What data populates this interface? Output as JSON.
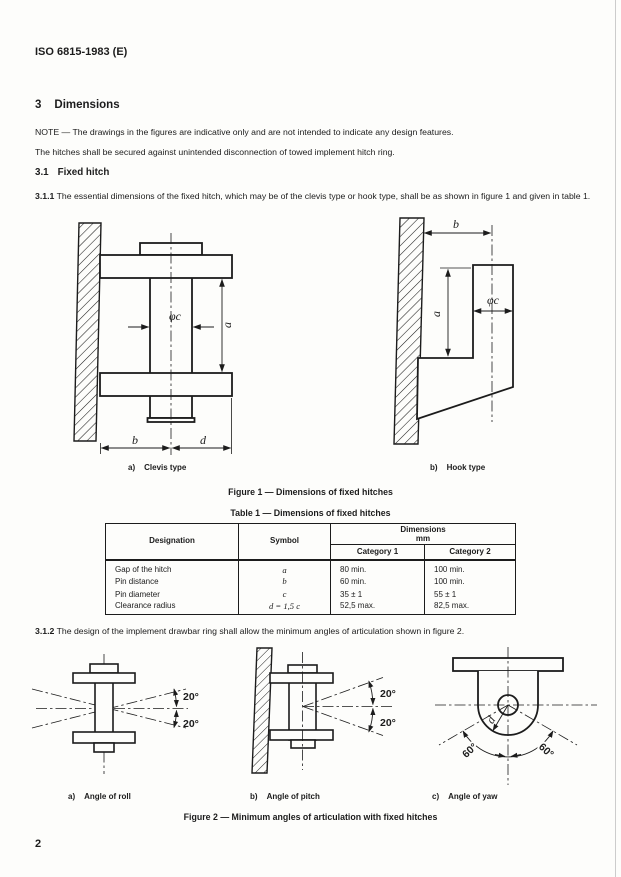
{
  "page": {
    "header": "ISO 6815-1983 (E)",
    "page_number": "2"
  },
  "sections": {
    "s3_num": "3",
    "s3_title": "Dimensions",
    "note": "NOTE — The drawings in the figures are indicative only and are not intended to indicate any design features.",
    "para1": "The hitches shall be secured against unintended disconnection of towed implement hitch ring.",
    "s31_num": "3.1",
    "s31_title": "Fixed hitch",
    "s311_num": "3.1.1",
    "s311_text": "The essential dimensions of the fixed hitch, which may be of the clevis type or hook type, shall be as shown in figure 1 and given in table 1.",
    "s312_num": "3.1.2",
    "s312_text": "The design of the implement drawbar ring shall allow the minimum angles of articulation shown in figure 2."
  },
  "figure1": {
    "caption": "Figure 1 — Dimensions of fixed hitches",
    "clevis_prefix": "a)",
    "clevis_label": "Clevis type",
    "hook_prefix": "b)",
    "hook_label": "Hook type",
    "dim_a": "a",
    "dim_b": "b",
    "dim_d": "d",
    "dim_phi_c": "φc"
  },
  "table1": {
    "caption": "Table 1 — Dimensions of fixed hitches",
    "col_designation": "Designation",
    "col_symbol": "Symbol",
    "col_dimensions": "Dimensions",
    "col_unit": "mm",
    "col_cat1": "Category 1",
    "col_cat2": "Category 2",
    "rows": [
      {
        "designation": "Gap of the hitch",
        "symbol": "a",
        "cat1": "80 min.",
        "cat2": "100 min."
      },
      {
        "designation": "Pin distance",
        "symbol": "b",
        "cat1": "60 min.",
        "cat2": "100 min."
      },
      {
        "designation": "Pin diameter",
        "symbol": "c",
        "cat1": "35 ± 1",
        "cat2": "55 ± 1"
      },
      {
        "designation": "Clearance radius",
        "symbol": "d = 1,5 c",
        "cat1": "52,5 max.",
        "cat2": "82,5 max."
      }
    ]
  },
  "figure2": {
    "caption": "Figure 2 — Minimum angles of articulation with fixed hitches",
    "roll_prefix": "a)",
    "roll_label": "Angle of roll",
    "pitch_prefix": "b)",
    "pitch_label": "Angle of pitch",
    "yaw_prefix": "c)",
    "yaw_label": "Angle of yaw",
    "angle_roll": "20°",
    "angle_pitch": "20°",
    "angle_yaw": "60°",
    "yaw_radius": "d"
  }
}
